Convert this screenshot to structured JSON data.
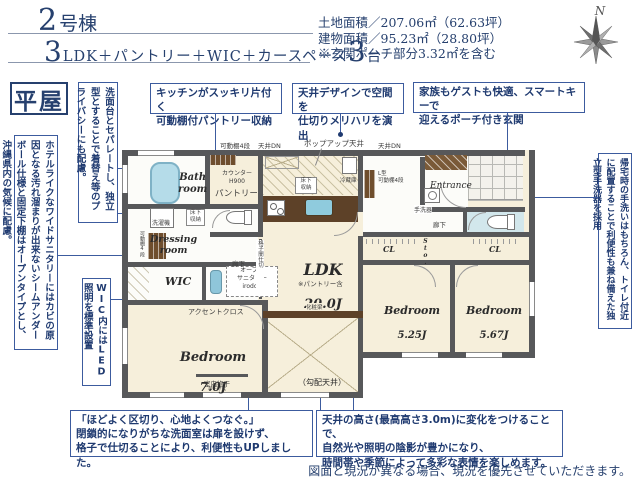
{
  "header": {
    "building_no": "2",
    "building_label": "号棟",
    "plan_num1": "3",
    "plan_text": "LDK＋パントリー＋WIC＋カースペース",
    "plan_num2": "3",
    "plan_unit": "台",
    "land_area": "土地面積／207.06㎡（62.63坪）",
    "building_area": "建物面積／95.23㎡（28.80坪）",
    "porch_note": "※玄関ポーチ部分3.32㎡を含む",
    "compass_north": "N"
  },
  "badge": {
    "label": "平屋"
  },
  "callouts": {
    "washstand": "洗面台とセパレートし、独立型とすることで着替え等のプライバシーにも配慮。",
    "hotel_sanitary": "ホテルライクなワイドサニタリーにはカビの原因となる汚れ溜まりが出来ないシームアンダーボール仕様と固定下棚はオープンタイプとし、沖縄県内の気候に配慮。",
    "wic_led": "WIC内にはLED照明を標準設置",
    "kitchen_pantry": "キッチンがスッキリ片付く\n可動棚付パントリー収納",
    "ceiling_design": "天井デザインで空間を\n仕切りメリハリを演出",
    "smart_entrance": "家族もゲストも快適、スマートキーで\n迎えるポーチ付き玄関",
    "handwash": "帰宅時の手洗いはもちろん、トイレ付近に配置することで利便性も兼ね備えた独立型手洗器を採用",
    "lattice_partition": "「ほどよく区切り、心地よくつなぐ。」\n閉鎖的になりがちな洗面室は扉を設けず、\n格子で仕切ることにより、利便性もUPしました。",
    "ceiling_height": "天井の高さ(最高高さ3.0m)に変化をつけることで、\n自然光や照明の陰影が豊かになり、\n時間帯や季節によって多彩な表情を楽しめます。"
  },
  "plan": {
    "annotations": {
      "shelf4_top": "可動棚4段",
      "ceiling_dn_left": "天井DN",
      "popup_ceiling": "ポップアップ天井",
      "ceiling_dn_right": "天井DN",
      "counter": "カウンター\nH900",
      "washer": "洗濯機",
      "underfloor_storage1": "床下\n収納",
      "underfloor_storage2": "床下\n収納",
      "shelf4_vertical": "可動棚4段",
      "open_sanitary": "オープン\nサニタリー\nirodori",
      "accent_cloth": "アクセントクロス",
      "indoor_drying": "室内物干",
      "hanging_type": "吊下げ式",
      "pantry_included": "※パントリー含",
      "fridge": "冷蔵庫",
      "decorative_beam": "化粧梁",
      "sloped_ceiling": "（勾配天井）",
      "lattice": "格子間仕切",
      "l_shelf": "L型\n可動棚4段",
      "handwash_basin": "手洗器",
      "hallway1": "廊下",
      "hallway2": "廊下"
    },
    "rooms": {
      "bath": "Bath\nroom",
      "pantry": "パントリー",
      "dressing": "Dressing\nroom",
      "wic": "WIC",
      "bedroom1_name": "Bedroom",
      "bedroom1_size": "7.0J",
      "ldk_name": "LDK",
      "ldk_size": "20.0J",
      "entrance": "Entrance",
      "closet1": "CL",
      "storage": "Sto.",
      "closet2": "CL",
      "bedroom2_name": "Bedroom",
      "bedroom2_size": "5.25J",
      "bedroom3_name": "Bedroom",
      "bedroom3_size": "5.67J"
    }
  },
  "footer": {
    "disclaimer": "図面と現況が異なる場合、現況を優先させていただきます。"
  },
  "colors": {
    "navy": "#26406e",
    "callout_border": "#3c5b9e",
    "wall": "#57585a",
    "floor": "#f6efdb"
  }
}
